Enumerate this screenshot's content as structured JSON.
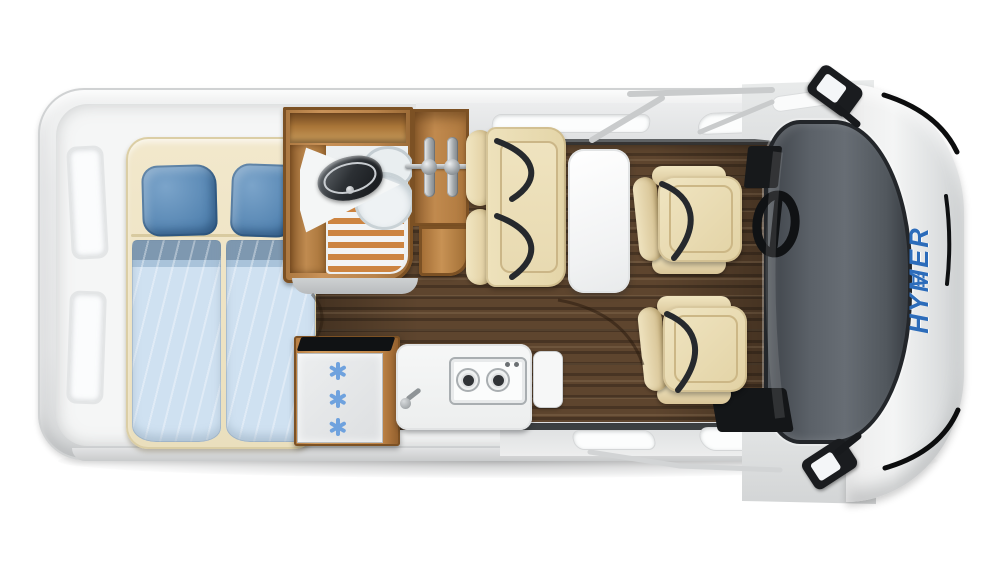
{
  "title": "Campervan floor plan — top view",
  "brand": {
    "mark": "≡",
    "name": "HYMER",
    "logo_color": "#2c6cba"
  },
  "areas": {
    "bedroom": {
      "name": "rear transverse bed",
      "pillow_count": 2,
      "duvet_count": 2
    },
    "bathroom": {
      "name": "wet room",
      "fixtures": [
        "corner-sink",
        "toilet",
        "shower-duckboard"
      ]
    },
    "wardrobe": {
      "name": "wardrobe",
      "hanger_count": 2
    },
    "lounge": {
      "name": "dinette",
      "bench_seatbelt_count": 2,
      "swivel_seat_count": 2,
      "table_count": 1
    },
    "kitchen": {
      "name": "kitchenette",
      "burner_count": 2,
      "stove_knob_count": 2,
      "fridge_snowflake_count": 3
    },
    "cab": {
      "name": "driver cab",
      "mirror_count": 2,
      "steering_wheel": true
    }
  },
  "colors": {
    "body_gray": "#e9eaeb",
    "windshield_gray": "#565c63",
    "floor_wood": "#5e452e",
    "furniture_wood": "#c08a4f",
    "cushion_cream": "#ecdfb9",
    "pillow_blue": "#5585b2",
    "duvet_blue": "#cfe1f1",
    "snowflake_blue": "#6fa2de",
    "hymer_blue": "#2c6cba",
    "seatbelt_black": "#26292d"
  }
}
